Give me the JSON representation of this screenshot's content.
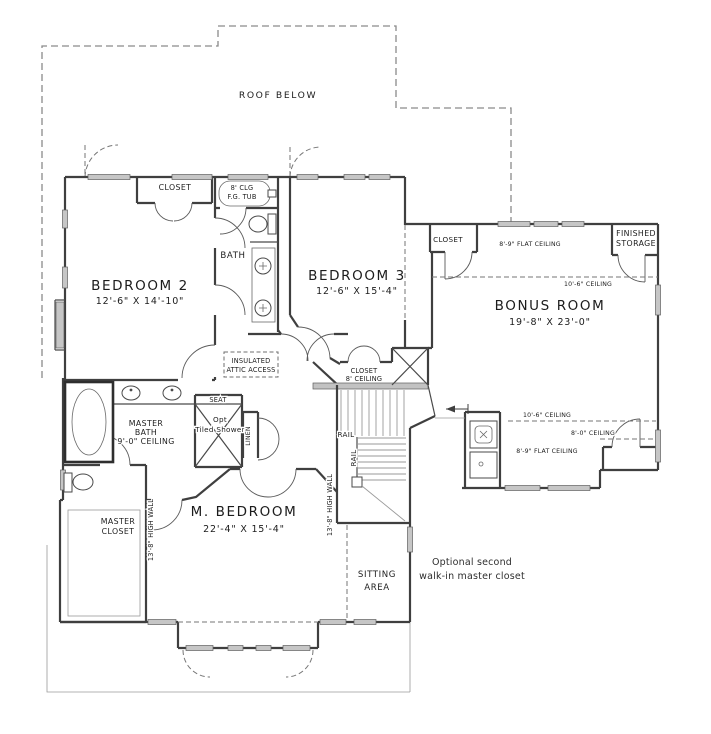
{
  "plan": {
    "roof_note": "ROOF BELOW",
    "rooms": {
      "bedroom2_name": "BEDROOM 2",
      "bedroom2_dims": "12'-6\" X 14'-10\"",
      "bedroom3_name": "BEDROOM 3",
      "bedroom3_dims": "12'-6\" X 15'-4\"",
      "bonus_name": "BONUS ROOM",
      "bonus_dims": "19'-8\" X 23'-0\"",
      "master_bedroom_name": "M. BEDROOM",
      "master_bedroom_dims": "22'-4\" X 15'-4\"",
      "sitting_line1": "SITTING",
      "sitting_line2": "AREA",
      "finished_storage_line1": "FINISHED",
      "finished_storage_line2": "STORAGE"
    },
    "bath": {
      "label": "BATH",
      "tub_line1": "8' CLG",
      "tub_line2": "F.G. TUB",
      "master_line1": "MASTER",
      "master_line2": "BATH",
      "master_line3": "9'-0\" CEILING",
      "seat": "SEAT",
      "shower_line1": "Opt",
      "shower_line2": "Tiled Shower",
      "linen": "LINEN"
    },
    "closets": {
      "bedroom2": "CLOSET",
      "bonus": "CLOSET",
      "hall_line1": "CLOSET",
      "hall_line2": "8' CEILING",
      "master_line1": "MASTER",
      "master_line2": "CLOSET"
    },
    "ceilings": {
      "flat_top": "8'-9\" FLAT CEILING",
      "main_top": "10'-6\" CEILING",
      "main_bottom": "10'-6\" CEILING",
      "low": "8'-0\" CEILING",
      "flat_bottom": "8'-9\" FLAT CEILING"
    },
    "stairs": {
      "rail_1": "RAIL",
      "rail_2": "RAIL",
      "high_wall_1": "13'-8\" HIGH WALL",
      "high_wall_2": "13'-8\" HIGH WALL"
    },
    "notes": {
      "attic_line1": "INSULATED",
      "attic_line2": "ATTIC ACCESS",
      "optional_line1": "Optional second",
      "optional_line2": "walk-in master closet"
    },
    "colors": {
      "wall": "#3f3f3f",
      "window_fill": "#c6c6c6",
      "dash": "#767676"
    }
  }
}
